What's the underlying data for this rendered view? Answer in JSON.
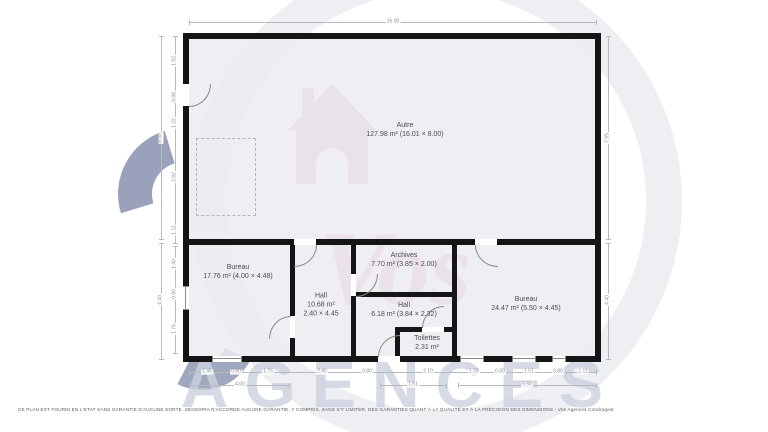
{
  "plan": {
    "rooms": [
      {
        "name": "Autre",
        "area": "127.98 m² (16.01 × 8.00)"
      },
      {
        "name": "Bureau",
        "area": "17.76 m² (4.00 × 4.48)"
      },
      {
        "name": "Hall",
        "area": "10.68 m²",
        "size": "2.40 × 4.45"
      },
      {
        "name": "Archives",
        "area": "7.70 m² (3.85 × 2.00)"
      },
      {
        "name": "Hall",
        "area": "6.18 m² (3.84 × 2.32)"
      },
      {
        "name": "Toilettes",
        "area": "2.31 m²"
      },
      {
        "name": "Bureau",
        "area": "24.47 m² (5.50 × 4.45)"
      }
    ],
    "dimensions": {
      "top": [
        "16.00"
      ],
      "left_outer": [
        "8.00",
        "4.40"
      ],
      "left_inner": [
        "1.92",
        "0.88",
        "1.22",
        "2.82",
        "1.11",
        "1.40",
        "0.90",
        "1.76"
      ],
      "right": [
        "7.95",
        "4.40"
      ],
      "bottom_row1": [
        "1.45",
        "0.80",
        "1.75",
        "2.40",
        "0.80",
        "2.10",
        "1.28",
        "0.80",
        "1.51",
        "0.80",
        "1.11"
      ],
      "bottom_row2": [
        "4.00",
        "1.61",
        "5.50"
      ]
    }
  },
  "watermark": {
    "script_text": "Vos",
    "block_text": "AGENCES"
  },
  "footer": {
    "disclaimer": "CE PLAN EST FOURNI EN L'ETAT SANS GARANTIE D'AUCUNE SORTE. SENSOPIA N'ACCORDE AUCUNE GARANTIE, Y COMPRIS, SANS S'Y LIMITER, DES GARANTIES QUANT À LA QUALITÉ ET À LA PRÉCISION DES DIMENSIONS - Vos Agences Condrogest"
  },
  "colors": {
    "wall": "#151515",
    "dimension_text": "#8d8d95",
    "room_text": "#4c4c4f",
    "watermark_pink": "#cf8fa0",
    "watermark_blue": "#9099b4",
    "watermark_gray": "#ccd2e0"
  }
}
